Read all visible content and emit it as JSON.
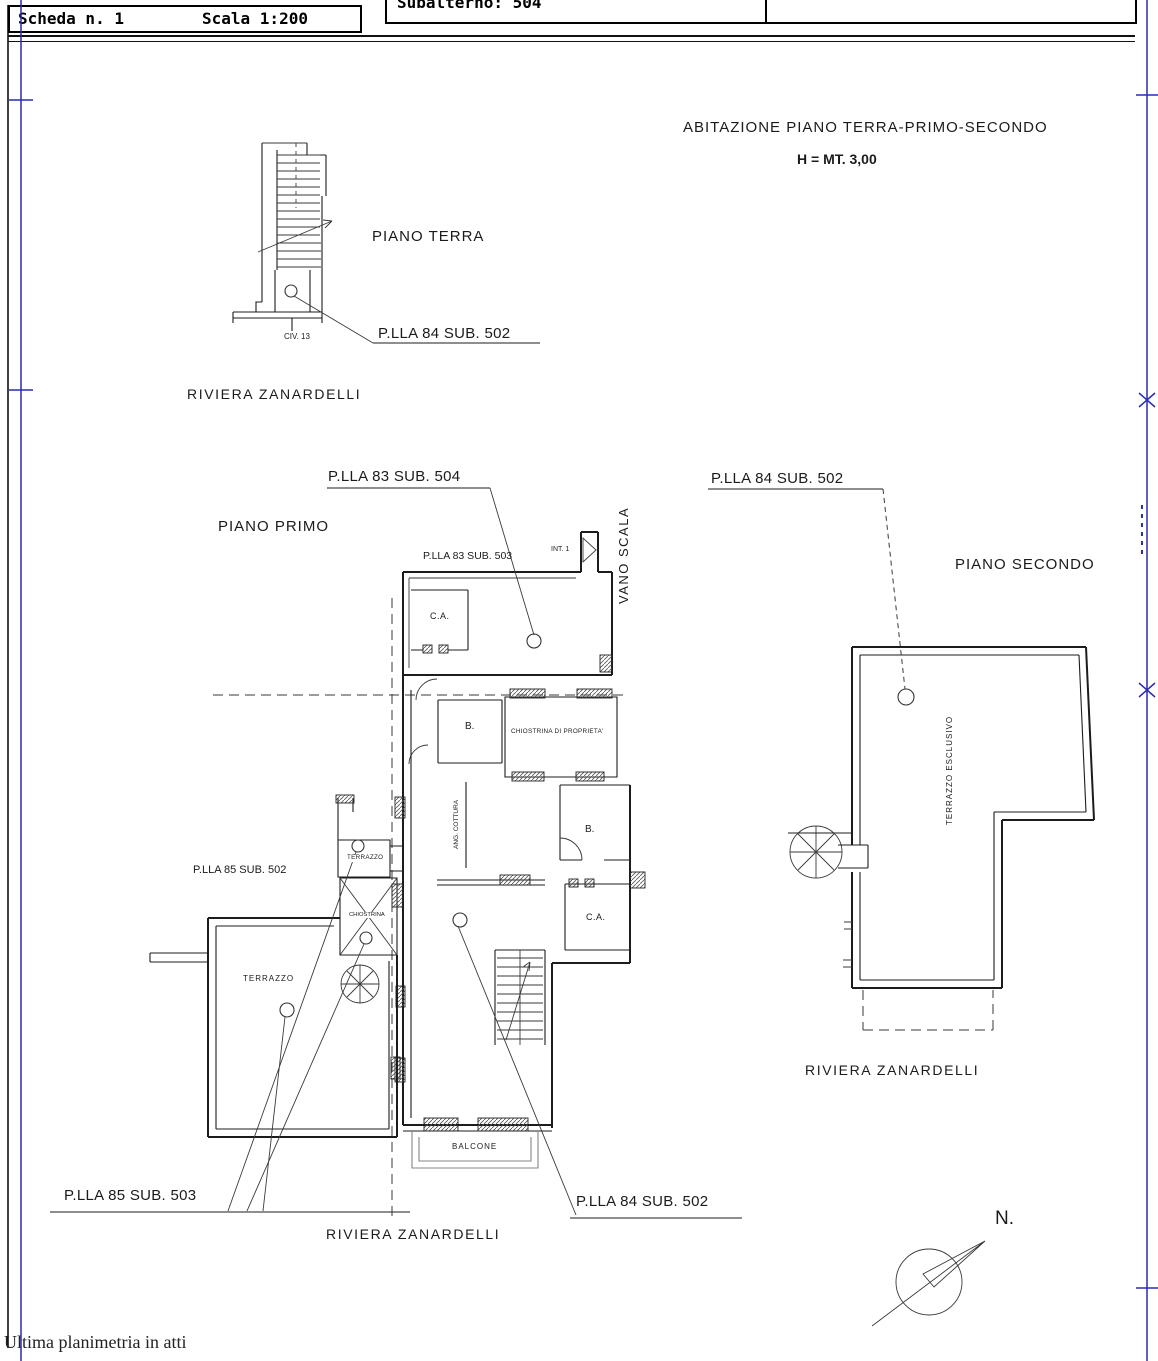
{
  "header": {
    "scheda": "Scheda n. 1",
    "scala": "Scala 1:200",
    "subalterno": "Subalterno: 504",
    "provincia": "Prov. Roma",
    "numero": "N.5055"
  },
  "title": {
    "abitazione": "ABITAZIONE  PIANO TERRA-PRIMO-SECONDO",
    "altezza": "H = MT. 3,00"
  },
  "piano_terra": {
    "label": "PIANO TERRA",
    "civico": "CIV. 13",
    "parcel": "P.LLA 84 SUB. 502",
    "street": "RIVIERA ZANARDELLI"
  },
  "piano_primo": {
    "label": "PIANO PRIMO",
    "parcel_top": "P.LLA 83 SUB. 504",
    "parcel_small_top": "P.LLA 83 SUB. 503",
    "parcel_left": "P.LLA 85 SUB. 502",
    "parcel_bottom_left": "P.LLA 85 SUB. 503",
    "parcel_bottom_right": "P.LLA 84 SUB. 502",
    "vano_scala": "VANO SCALA",
    "interno": "INT. 1",
    "street": "RIVIERA ZANARDELLI",
    "rooms": {
      "ca_top": "C.A.",
      "b_top": "B.",
      "chiostrina_proprieta": "CHIOSTRINA DI PROPRIETA'",
      "ang_cottura": "ANG. COTTURA",
      "terrazzo_small": "TERRAZZO",
      "chiostrina": "CHIOSTRINA",
      "b_right": "B.",
      "ca_right": "C.A.",
      "terrazzo_big": "TERRAZZO",
      "balcone": "BALCONE"
    }
  },
  "piano_secondo": {
    "label": "PIANO SECONDO",
    "parcel": "P.LLA 84 SUB. 502",
    "terrazzo": "TERRAZZO ESCLUSIVO",
    "street": "RIVIERA ZANARDELLI"
  },
  "compass": {
    "north": "N."
  },
  "footer": {
    "note": "Ultima planimetria in atti"
  },
  "colors": {
    "line": "#1c1c1c",
    "fold_blue": "#2b2bb0",
    "paper": "#ffffff"
  }
}
